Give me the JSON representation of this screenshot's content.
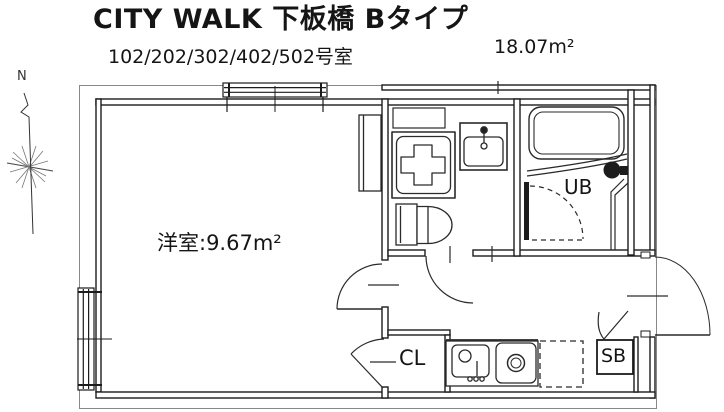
{
  "header": {
    "title": "CITY WALK 下板橋 Bタイプ",
    "room_numbers": "102/202/302/402/502号室",
    "total_area": "18.07m²"
  },
  "floor_plan": {
    "compass_label": "N",
    "main_room_label": "洋室:9.67m²",
    "unit_bath_label": "UB",
    "closet_label": "CL",
    "shoe_box_label": "SB"
  },
  "colors": {
    "line": "#1c1c1c",
    "background": "#ffffff",
    "text": "#111111"
  }
}
